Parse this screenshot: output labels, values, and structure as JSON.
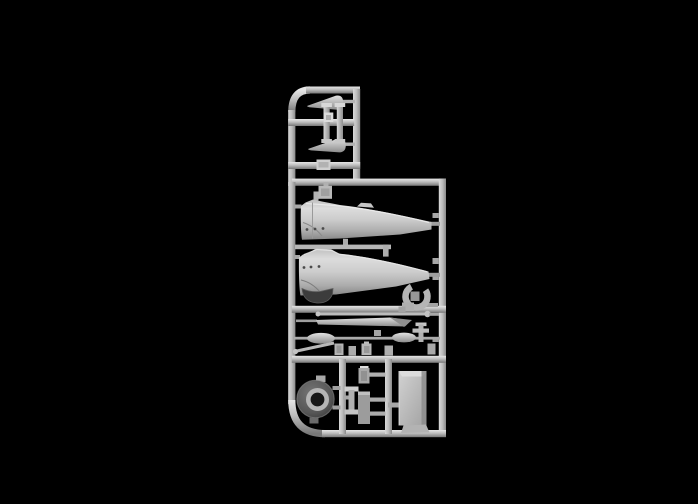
{
  "scene": {
    "type": "photograph",
    "subject": "Injection-moulded plastic model kit sprue (parts runner) with aircraft model parts, lit from above on a black background",
    "background_color": "#000000"
  },
  "colors": {
    "background": "#000000",
    "plastic_base": "#bdbdbd",
    "plastic_highlight": "#e6e6e6",
    "plastic_mid": "#a3a3a3",
    "plastic_shadow": "#787878",
    "dark_part": "#3c3c3c",
    "hole": "#161616"
  },
  "sprue": {
    "material": "light grey polystyrene",
    "orientation": "vertical runner frame, rounded top-left and bottom-left corners",
    "sections": [
      {
        "name": "top-cell",
        "contents": "two tapered cone parts pointing left and two small capped cylindrical pins"
      },
      {
        "name": "fuselage-cell",
        "contents": "two aircraft fuselage halves lying nose-left, a small square fitting, a dark curved cowl piece and a C-shaped bracket"
      },
      {
        "name": "small-parts-cell",
        "contents": "a long straight rod, a long tapered blade, two teardrop tank halves on a thin runner, a diagonal rod and assorted small fittings"
      },
      {
        "name": "bottom-cell",
        "contents": "a dark engine cowling ring with open centre, an I-beam fitting, a capped bottle fitting, a tall box fitting, a large rectangular panel and a small wedge"
      }
    ],
    "parts": [
      {
        "id": "part-cone-upper",
        "label": "tapered cone half (upper)"
      },
      {
        "id": "part-cone-lower",
        "label": "tapered cone half (lower)"
      },
      {
        "id": "part-pin-left",
        "label": "capped cylindrical pin (left)"
      },
      {
        "id": "part-pin-right",
        "label": "capped cylindrical pin (right)"
      },
      {
        "id": "part-clip-square",
        "label": "small square clip fitting"
      },
      {
        "id": "part-number-tab",
        "label": "moulded tab on rail"
      },
      {
        "id": "part-fitting-hanging",
        "label": "small square fitting hanging from top rail"
      },
      {
        "id": "part-fuselage-upper",
        "label": "fuselage half, nose left (upper)"
      },
      {
        "id": "part-fuselage-lower",
        "label": "fuselage half, nose left (lower)"
      },
      {
        "id": "part-cowl-dark",
        "label": "dark curved cowl piece"
      },
      {
        "id": "part-bracket-c",
        "label": "C-shaped bracket with foot"
      },
      {
        "id": "part-rod-long",
        "label": "long straight rod (pitot/antenna)"
      },
      {
        "id": "part-blade-tapered",
        "label": "long tapered blade"
      },
      {
        "id": "part-tank-left",
        "label": "teardrop tank half (left)"
      },
      {
        "id": "part-tank-right",
        "label": "teardrop tank half (right)"
      },
      {
        "id": "part-rod-diagonal",
        "label": "short diagonal rod"
      },
      {
        "id": "part-fitting-1",
        "label": "small block fitting"
      },
      {
        "id": "part-fitting-2",
        "label": "small block fitting"
      },
      {
        "id": "part-fitting-3",
        "label": "small block fitting"
      },
      {
        "id": "part-fitting-4",
        "label": "small block fitting"
      },
      {
        "id": "part-fitting-anchor",
        "label": "T-shaped fitting"
      },
      {
        "id": "part-fitting-5",
        "label": "small block fitting on right rail"
      },
      {
        "id": "part-cowling-ring",
        "label": "engine cowling ring with open centre"
      },
      {
        "id": "part-ibeam",
        "label": "I-beam fitting"
      },
      {
        "id": "part-bottle",
        "label": "capped bottle fitting"
      },
      {
        "id": "part-box-tall",
        "label": "tall box fitting"
      },
      {
        "id": "part-panel-large",
        "label": "large rectangular panel"
      },
      {
        "id": "part-wedge",
        "label": "small wedge part"
      }
    ]
  }
}
